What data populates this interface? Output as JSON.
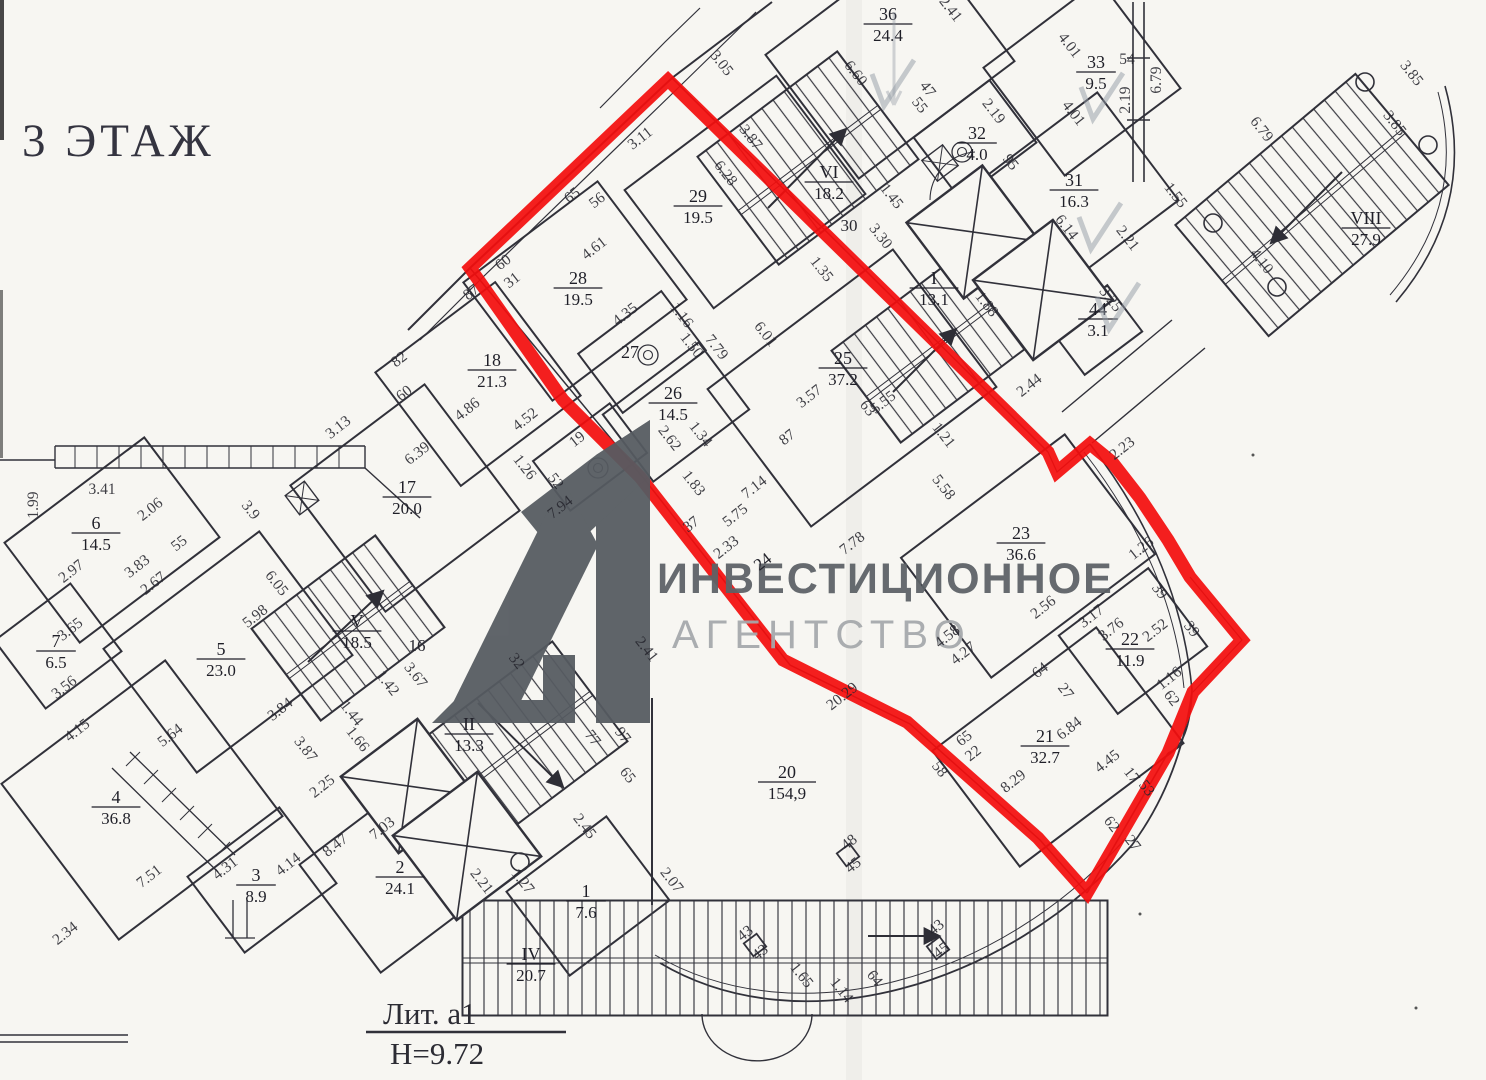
{
  "header": {
    "floor_title": "3 ЭТАЖ"
  },
  "watermark": {
    "line1": "ИНВЕСТИЦИОННОЕ",
    "line2": "АГЕНТСТВО",
    "logo": "A1-logo",
    "logo_color": "#565b61",
    "line1_color": "#5d6267",
    "line2_color": "#a6a9ac"
  },
  "footer": {
    "liter_label": "Лит. a1",
    "height_label": "H=9.72"
  },
  "highlight": {
    "color": "#f30e0e",
    "stroke_width": 13,
    "points": "668,80 1048,452 1057,472 1090,444 1112,462 1140,498 1168,540 1190,577 1242,640 1193,692 1168,753 1087,893 1038,838 907,722 783,660 640,477 563,400 470,268"
  },
  "rooms": [
    {
      "num": "36",
      "area": "24.4",
      "x": 888,
      "y": 20
    },
    {
      "num": "33",
      "area": "9.5",
      "x": 1096,
      "y": 68
    },
    {
      "num": "31",
      "area": "16.3",
      "x": 1074,
      "y": 186
    },
    {
      "num": "VIII",
      "area": "27.9",
      "x": 1366,
      "y": 224
    },
    {
      "num": "VI",
      "area": "18.2",
      "x": 829,
      "y": 178
    },
    {
      "num": "32",
      "area": "4.0",
      "x": 977,
      "y": 139
    },
    {
      "num": "I",
      "area": "13.1",
      "x": 934,
      "y": 284
    },
    {
      "num": "44",
      "area": "3.1",
      "x": 1098,
      "y": 315
    },
    {
      "num": "29",
      "area": "19.5",
      "x": 698,
      "y": 202
    },
    {
      "num": "28",
      "area": "19.5",
      "x": 578,
      "y": 284
    },
    {
      "num": "18",
      "area": "21.3",
      "x": 492,
      "y": 366
    },
    {
      "num": "27",
      "area": "",
      "x": 630,
      "y": 358
    },
    {
      "num": "26",
      "area": "14.5",
      "x": 673,
      "y": 399
    },
    {
      "num": "25",
      "area": "37.2",
      "x": 843,
      "y": 364
    },
    {
      "num": "17",
      "area": "20.0",
      "x": 407,
      "y": 493
    },
    {
      "num": "23",
      "area": "36.6",
      "x": 1021,
      "y": 539
    },
    {
      "num": "22",
      "area": "11.9",
      "x": 1130,
      "y": 645
    },
    {
      "num": "21",
      "area": "32.7",
      "x": 1045,
      "y": 742
    },
    {
      "num": "20",
      "area": "154,9",
      "x": 787,
      "y": 778
    },
    {
      "num": "V",
      "area": "18.5",
      "x": 357,
      "y": 627
    },
    {
      "num": "II",
      "area": "13.3",
      "x": 469,
      "y": 730
    },
    {
      "num": "2",
      "area": "24.1",
      "x": 400,
      "y": 873
    },
    {
      "num": "1",
      "area": "7.6",
      "x": 586,
      "y": 897
    },
    {
      "num": "IV",
      "area": "20.7",
      "x": 531,
      "y": 960
    },
    {
      "num": "6",
      "area": "14.5",
      "x": 96,
      "y": 529
    },
    {
      "num": "5",
      "area": "23.0",
      "x": 221,
      "y": 655
    },
    {
      "num": "7",
      "area": "6.5",
      "x": 56,
      "y": 647
    },
    {
      "num": "4",
      "area": "36.8",
      "x": 116,
      "y": 803
    },
    {
      "num": "3",
      "area": "8.9",
      "x": 256,
      "y": 881
    }
  ],
  "plain_labels": [
    {
      "t": "30",
      "x": 849,
      "y": 231,
      "r": 0
    },
    {
      "t": "16",
      "x": 417,
      "y": 651,
      "r": 0
    },
    {
      "t": "24",
      "x": 766,
      "y": 566,
      "r": -38
    }
  ],
  "dimensions": [
    {
      "t": "3.05",
      "x": 718,
      "y": 66,
      "r": 52
    },
    {
      "t": "6.60",
      "x": 852,
      "y": 76,
      "r": 52
    },
    {
      "t": "2.41",
      "x": 947,
      "y": 12,
      "r": 52
    },
    {
      "t": "4.01",
      "x": 1066,
      "y": 48,
      "r": 52
    },
    {
      "t": "54",
      "x": 1127,
      "y": 64,
      "r": 0
    },
    {
      "t": "6.79",
      "x": 1161,
      "y": 80,
      "r": -90
    },
    {
      "t": "2.19",
      "x": 1130,
      "y": 100,
      "r": -90
    },
    {
      "t": "4.01",
      "x": 1070,
      "y": 116,
      "r": 52
    },
    {
      "t": "3.85",
      "x": 1408,
      "y": 76,
      "r": 52
    },
    {
      "t": "3.85",
      "x": 1391,
      "y": 126,
      "r": 52
    },
    {
      "t": "6.79",
      "x": 1258,
      "y": 132,
      "r": 52
    },
    {
      "t": "1.55",
      "x": 1172,
      "y": 198,
      "r": 52
    },
    {
      "t": "2.21",
      "x": 1124,
      "y": 241,
      "r": 52
    },
    {
      "t": "6.14",
      "x": 1063,
      "y": 230,
      "r": 52
    },
    {
      "t": "4.10",
      "x": 1258,
      "y": 264,
      "r": 52
    },
    {
      "t": "47",
      "x": 924,
      "y": 92,
      "r": 52
    },
    {
      "t": "55",
      "x": 916,
      "y": 108,
      "r": 52
    },
    {
      "t": "2.19",
      "x": 990,
      "y": 114,
      "r": 52
    },
    {
      "t": "95",
      "x": 1007,
      "y": 165,
      "r": 52
    },
    {
      "t": "1.45",
      "x": 888,
      "y": 199,
      "r": 52
    },
    {
      "t": "3.30",
      "x": 877,
      "y": 239,
      "r": 52
    },
    {
      "t": "3.87",
      "x": 747,
      "y": 140,
      "r": 52
    },
    {
      "t": "3.11",
      "x": 643,
      "y": 142,
      "r": -38
    },
    {
      "t": "6.28",
      "x": 722,
      "y": 176,
      "r": 52
    },
    {
      "t": "65",
      "x": 575,
      "y": 199,
      "r": -38
    },
    {
      "t": "56",
      "x": 600,
      "y": 204,
      "r": -38
    },
    {
      "t": "4.61",
      "x": 597,
      "y": 252,
      "r": -38
    },
    {
      "t": "60",
      "x": 506,
      "y": 266,
      "r": -38
    },
    {
      "t": "31",
      "x": 515,
      "y": 284,
      "r": -38
    },
    {
      "t": "87",
      "x": 474,
      "y": 296,
      "r": -38
    },
    {
      "t": "82",
      "x": 402,
      "y": 363,
      "r": -38
    },
    {
      "t": "60",
      "x": 407,
      "y": 397,
      "r": -38
    },
    {
      "t": "4.86",
      "x": 470,
      "y": 413,
      "r": -38
    },
    {
      "t": "6.39",
      "x": 420,
      "y": 457,
      "r": -38
    },
    {
      "t": "3.13",
      "x": 341,
      "y": 431,
      "r": -38
    },
    {
      "t": "4.35",
      "x": 628,
      "y": 318,
      "r": -38
    },
    {
      "t": "1.16",
      "x": 678,
      "y": 318,
      "r": 52
    },
    {
      "t": "1.50",
      "x": 688,
      "y": 348,
      "r": 52
    },
    {
      "t": "7.79",
      "x": 713,
      "y": 350,
      "r": 52
    },
    {
      "t": "6.01",
      "x": 762,
      "y": 337,
      "r": 52
    },
    {
      "t": "1.35",
      "x": 818,
      "y": 272,
      "r": 52
    },
    {
      "t": "4.52",
      "x": 528,
      "y": 423,
      "r": -38
    },
    {
      "t": "1.26",
      "x": 521,
      "y": 470,
      "r": 52
    },
    {
      "t": "52",
      "x": 552,
      "y": 484,
      "r": 52
    },
    {
      "t": "19",
      "x": 580,
      "y": 443,
      "r": -38
    },
    {
      "t": "7.94",
      "x": 563,
      "y": 511,
      "r": -38
    },
    {
      "t": "2.62",
      "x": 666,
      "y": 441,
      "r": 52
    },
    {
      "t": "1.34",
      "x": 697,
      "y": 437,
      "r": 52
    },
    {
      "t": "1.83",
      "x": 690,
      "y": 486,
      "r": 52
    },
    {
      "t": "37",
      "x": 694,
      "y": 528,
      "r": -38
    },
    {
      "t": "2.33",
      "x": 729,
      "y": 551,
      "r": -38
    },
    {
      "t": "5.75",
      "x": 738,
      "y": 519,
      "r": -38
    },
    {
      "t": "7.14",
      "x": 757,
      "y": 491,
      "r": -38
    },
    {
      "t": "87",
      "x": 790,
      "y": 441,
      "r": -38
    },
    {
      "t": "3.57",
      "x": 812,
      "y": 400,
      "r": -38
    },
    {
      "t": "5.55",
      "x": 886,
      "y": 406,
      "r": -38
    },
    {
      "t": "63",
      "x": 864,
      "y": 411,
      "r": 52
    },
    {
      "t": "5.58",
      "x": 940,
      "y": 490,
      "r": 52
    },
    {
      "t": "7.78",
      "x": 855,
      "y": 547,
      "r": -38
    },
    {
      "t": "1.21",
      "x": 940,
      "y": 438,
      "r": 52
    },
    {
      "t": "2.44",
      "x": 1032,
      "y": 389,
      "r": -38
    },
    {
      "t": "3.25",
      "x": 1107,
      "y": 302,
      "r": 52
    },
    {
      "t": "1.88",
      "x": 983,
      "y": 307,
      "r": 52
    },
    {
      "t": "2.23",
      "x": 1125,
      "y": 452,
      "r": -38
    },
    {
      "t": "1.26",
      "x": 1144,
      "y": 552,
      "r": -38
    },
    {
      "t": "2.56",
      "x": 1046,
      "y": 611,
      "r": -38
    },
    {
      "t": "3.17",
      "x": 1094,
      "y": 620,
      "r": -38
    },
    {
      "t": "3.76",
      "x": 1114,
      "y": 633,
      "r": -38
    },
    {
      "t": "2.52",
      "x": 1158,
      "y": 634,
      "r": -38
    },
    {
      "t": "39",
      "x": 1156,
      "y": 594,
      "r": 52
    },
    {
      "t": "39",
      "x": 1188,
      "y": 632,
      "r": 52
    },
    {
      "t": "1.16",
      "x": 1172,
      "y": 682,
      "r": -38
    },
    {
      "t": "62",
      "x": 1168,
      "y": 701,
      "r": 52
    },
    {
      "t": "64",
      "x": 1043,
      "y": 674,
      "r": -38
    },
    {
      "t": "27",
      "x": 1062,
      "y": 694,
      "r": 52
    },
    {
      "t": "4.27",
      "x": 966,
      "y": 657,
      "r": -38
    },
    {
      "t": "4.58",
      "x": 950,
      "y": 640,
      "r": -38
    },
    {
      "t": "6.84",
      "x": 1072,
      "y": 732,
      "r": -38
    },
    {
      "t": "4.45",
      "x": 1110,
      "y": 765,
      "r": -38
    },
    {
      "t": "17",
      "x": 1128,
      "y": 778,
      "r": 52
    },
    {
      "t": "53",
      "x": 1143,
      "y": 791,
      "r": 52
    },
    {
      "t": "62",
      "x": 1108,
      "y": 827,
      "r": 52
    },
    {
      "t": "27",
      "x": 1129,
      "y": 846,
      "r": 52
    },
    {
      "t": "65",
      "x": 967,
      "y": 742,
      "r": -38
    },
    {
      "t": "22",
      "x": 976,
      "y": 757,
      "r": -38
    },
    {
      "t": "58",
      "x": 936,
      "y": 772,
      "r": 52
    },
    {
      "t": "8.29",
      "x": 1016,
      "y": 785,
      "r": -38
    },
    {
      "t": "20.29",
      "x": 845,
      "y": 700,
      "r": -38
    },
    {
      "t": "2.41",
      "x": 643,
      "y": 652,
      "r": 52
    },
    {
      "t": "2.07",
      "x": 668,
      "y": 883,
      "r": 52
    },
    {
      "t": "1.65",
      "x": 798,
      "y": 978,
      "r": 52
    },
    {
      "t": "1.14",
      "x": 838,
      "y": 993,
      "r": 52
    },
    {
      "t": "64",
      "x": 871,
      "y": 981,
      "r": 52
    },
    {
      "t": "2.45",
      "x": 581,
      "y": 829,
      "r": 52
    },
    {
      "t": "1.27",
      "x": 519,
      "y": 884,
      "r": 52
    },
    {
      "t": "2.21",
      "x": 478,
      "y": 884,
      "r": 52
    },
    {
      "t": "77",
      "x": 589,
      "y": 741,
      "r": 52
    },
    {
      "t": "97",
      "x": 619,
      "y": 738,
      "r": 52
    },
    {
      "t": "65",
      "x": 624,
      "y": 778,
      "r": 52
    },
    {
      "t": "1.42",
      "x": 384,
      "y": 686,
      "r": 52
    },
    {
      "t": "3.67",
      "x": 412,
      "y": 678,
      "r": 52
    },
    {
      "t": "32",
      "x": 513,
      "y": 664,
      "r": 52
    },
    {
      "t": "1.44",
      "x": 348,
      "y": 716,
      "r": 52
    },
    {
      "t": "1.66",
      "x": 354,
      "y": 742,
      "r": 52
    },
    {
      "t": "7.03",
      "x": 385,
      "y": 832,
      "r": -38
    },
    {
      "t": "8.47",
      "x": 338,
      "y": 849,
      "r": -38
    },
    {
      "t": "2.25",
      "x": 325,
      "y": 790,
      "r": -38
    },
    {
      "t": "3.84",
      "x": 283,
      "y": 713,
      "r": -38
    },
    {
      "t": "5.64",
      "x": 173,
      "y": 739,
      "r": -38
    },
    {
      "t": "4.15",
      "x": 80,
      "y": 734,
      "r": -38
    },
    {
      "t": "7.51",
      "x": 152,
      "y": 880,
      "r": -38
    },
    {
      "t": "2.34",
      "x": 68,
      "y": 937,
      "r": -38
    },
    {
      "t": "4.31",
      "x": 228,
      "y": 872,
      "r": -38
    },
    {
      "t": "4.14",
      "x": 291,
      "y": 868,
      "r": -38
    },
    {
      "t": "3.87",
      "x": 302,
      "y": 752,
      "r": 52
    },
    {
      "t": "2.97",
      "x": 74,
      "y": 575,
      "r": -38
    },
    {
      "t": "3.83",
      "x": 140,
      "y": 570,
      "r": -38
    },
    {
      "t": "2.67",
      "x": 156,
      "y": 587,
      "r": -38
    },
    {
      "t": "3.65",
      "x": 73,
      "y": 633,
      "r": -38
    },
    {
      "t": "3.56",
      "x": 67,
      "y": 691,
      "r": -38
    },
    {
      "t": "1.99",
      "x": 38,
      "y": 505,
      "r": -90
    },
    {
      "t": "3.41",
      "x": 102,
      "y": 494,
      "r": 0
    },
    {
      "t": "2.06",
      "x": 153,
      "y": 513,
      "r": -38
    },
    {
      "t": "55",
      "x": 182,
      "y": 547,
      "r": -38
    },
    {
      "t": "5.98",
      "x": 258,
      "y": 620,
      "r": -38
    },
    {
      "t": "6.05",
      "x": 273,
      "y": 586,
      "r": 52
    },
    {
      "t": "3.9",
      "x": 247,
      "y": 513,
      "r": 52
    },
    {
      "t": "48",
      "x": 852,
      "y": 846,
      "r": -38
    },
    {
      "t": "45",
      "x": 856,
      "y": 869,
      "r": -38
    },
    {
      "t": "43",
      "x": 748,
      "y": 937,
      "r": -38
    },
    {
      "t": "43",
      "x": 763,
      "y": 956,
      "r": -38
    },
    {
      "t": "43",
      "x": 939,
      "y": 931,
      "r": -38
    },
    {
      "t": "45",
      "x": 944,
      "y": 954,
      "r": -38
    }
  ],
  "pencil_checkmarks": [
    {
      "x": 888,
      "y": 90
    },
    {
      "x": 1097,
      "y": 103
    },
    {
      "x": 1095,
      "y": 233
    },
    {
      "x": 1113,
      "y": 313
    }
  ]
}
